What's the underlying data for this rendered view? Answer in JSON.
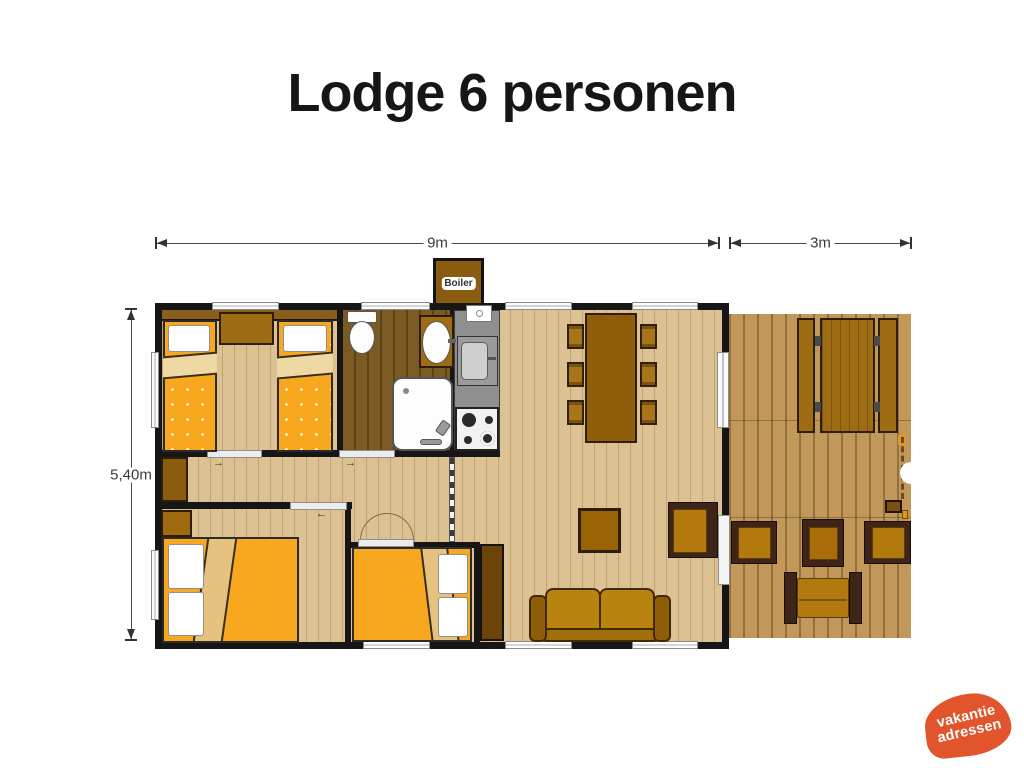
{
  "title": "Lodge 6 personen",
  "dimensions": {
    "main_width": "9m",
    "deck_width": "3m",
    "depth": "5,40m"
  },
  "boiler_label": "Boiler",
  "logo": {
    "line1": "vakantie",
    "line2": "adressen",
    "color": "#e2552c"
  },
  "colors": {
    "wall": "#161616",
    "interior_floor": "#dcc193",
    "bathroom_floor": "#7b5a23",
    "deck_floor": "#c1985a",
    "kitchen_counter": "#8f8f8f",
    "bed_duvet": "#f7a81e",
    "furniture_wood": "#9e6c12",
    "seat_cushion": "#b1790e",
    "dark_frame": "#3f2517",
    "logo_orange": "#e2552c"
  },
  "plan": {
    "rooms": [
      "twin-bedroom",
      "bathroom",
      "kitchen",
      "hallway",
      "double-bedroom-left",
      "double-bedroom-middle",
      "living-dining-room",
      "deck"
    ],
    "furniture": [
      "single-bed x2",
      "nightstand",
      "toilet",
      "washbasin",
      "shower",
      "kitchen-sink",
      "stove",
      "dining-table",
      "dining-chair x6",
      "double-bed x2",
      "wardrobe x3",
      "coffee-table",
      "armchair x3",
      "sofa",
      "loveseat",
      "picnic-table",
      "deck-side-table",
      "boiler"
    ]
  }
}
